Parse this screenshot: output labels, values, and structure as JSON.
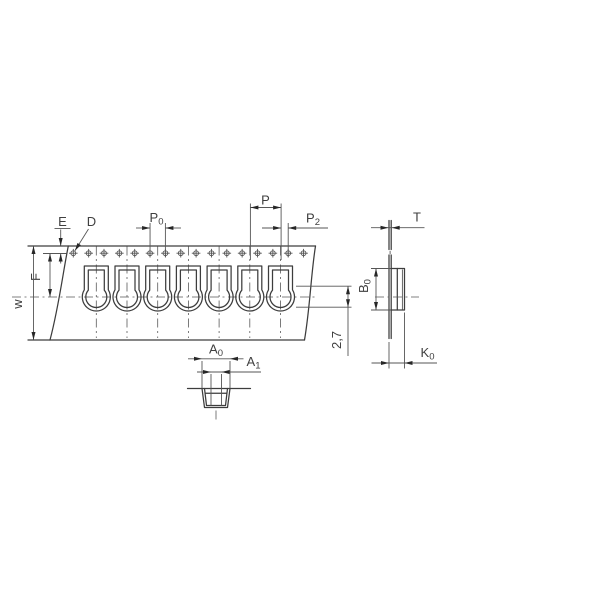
{
  "drawing": {
    "kind": "carrier-tape dimensional drawing",
    "background": "#ffffff",
    "line_color": "#3d3d3d",
    "text_color": "#3f3f3f",
    "sprocket_hole_count": 16,
    "pocket_count": 7
  },
  "dims": {
    "E": {
      "base": "E"
    },
    "D": {
      "base": "D"
    },
    "P0": {
      "base": "P",
      "sub": "0"
    },
    "P": {
      "base": "P"
    },
    "P2": {
      "base": "P",
      "sub": "2"
    },
    "T": {
      "base": "T"
    },
    "w": {
      "base": "w"
    },
    "F": {
      "base": "F"
    },
    "B0": {
      "base": "B",
      "sub": "0"
    },
    "d27": {
      "base": "2,7"
    },
    "K0": {
      "base": "K",
      "sub": "0"
    },
    "A0": {
      "base": "A",
      "sub": "0"
    },
    "A1": {
      "base": "A",
      "sub": "1"
    }
  }
}
